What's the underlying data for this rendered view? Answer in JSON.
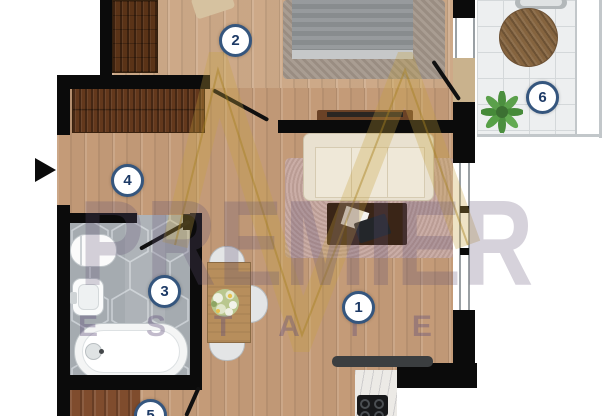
{
  "rooms": [
    {
      "name": "living-room",
      "label": "1"
    },
    {
      "name": "bedroom",
      "label": "2"
    },
    {
      "name": "bathroom",
      "label": "3"
    },
    {
      "name": "hallway",
      "label": "4"
    },
    {
      "name": "kitchen",
      "label": "5"
    },
    {
      "name": "balcony",
      "label": "6"
    }
  ],
  "watermark": {
    "brand": "PREMIER",
    "subtitle": "ESTATE"
  },
  "colors": {
    "wall": "#0b0b0b",
    "label_ring": "#35567e",
    "label_text": "#1d3a66",
    "logo_gold": "#c8a23c"
  }
}
